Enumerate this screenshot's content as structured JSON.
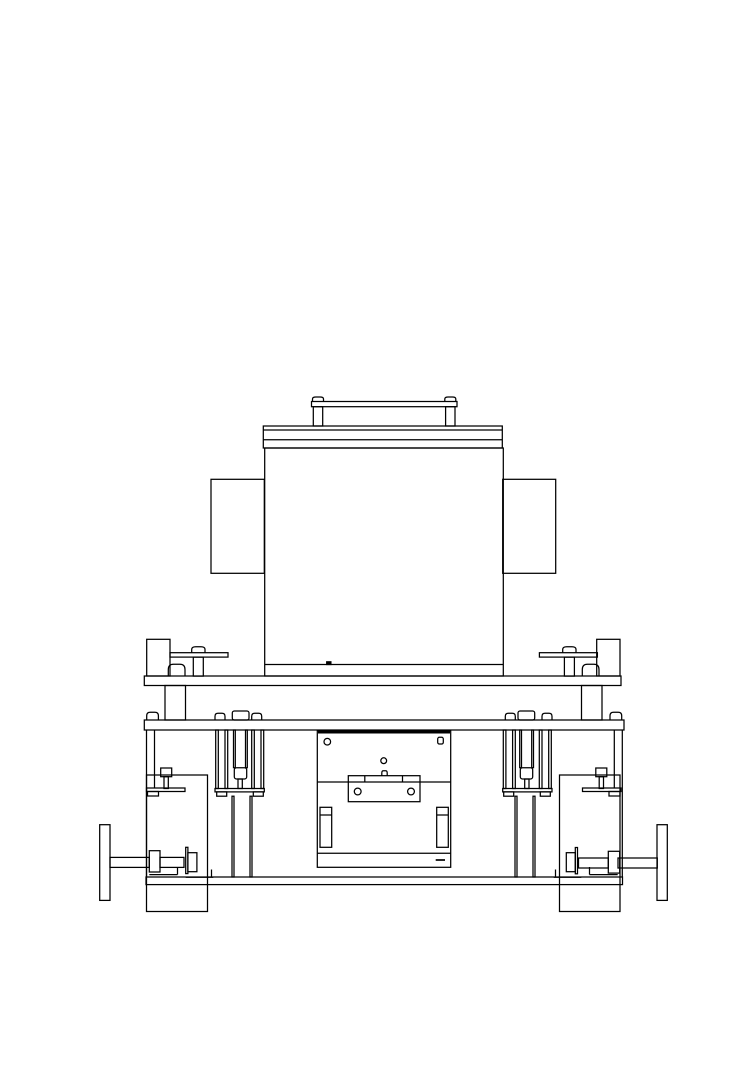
{
  "page": {
    "background": "#ffffff",
    "width": 755,
    "height": 1083
  },
  "drawing": {
    "description": "front-view-technical-line-drawing-of-machine-on-wheeled-base",
    "stroke_color": "#000000",
    "default_line_width": 1.25,
    "canvas": {
      "width": 755,
      "height": 1083
    },
    "shapes": [
      {
        "name": "lift-handle-rail",
        "type": "rect",
        "x": 311.5,
        "y": 401.5,
        "w": 145.5,
        "h": 5.2
      },
      {
        "name": "lift-handle-cap-left",
        "type": "dome",
        "x": 312.5,
        "y": 397,
        "w": 11,
        "h": 4.5
      },
      {
        "name": "lift-handle-cap-right",
        "type": "dome",
        "x": 444.8,
        "y": 397,
        "w": 11,
        "h": 4.5
      },
      {
        "name": "lift-handle-post-left",
        "type": "rect",
        "x": 313.3,
        "y": 406.7,
        "w": 9.4,
        "h": 19.3
      },
      {
        "name": "lift-handle-post-right",
        "type": "rect",
        "x": 445.6,
        "y": 406.7,
        "w": 9.4,
        "h": 19.3
      },
      {
        "name": "top-cover-plate",
        "type": "rect",
        "x": 263.3,
        "y": 426,
        "w": 239,
        "h": 22
      },
      {
        "name": "top-cover-seam-1",
        "type": "line",
        "x1": 263.3,
        "y1": 430,
        "x2": 502.3,
        "y2": 430
      },
      {
        "name": "top-cover-seam-2",
        "type": "line",
        "x1": 263.3,
        "y1": 439.7,
        "x2": 502.3,
        "y2": 439.7
      },
      {
        "name": "main-housing-body",
        "type": "rect",
        "x": 264.7,
        "y": 448,
        "w": 238.6,
        "h": 228
      },
      {
        "name": "main-housing-bottom-seam",
        "type": "line",
        "x1": 264.7,
        "y1": 664.5,
        "x2": 503.3,
        "y2": 664.5
      },
      {
        "name": "main-housing-weld-tick",
        "type": "rect",
        "x": 326.7,
        "y": 661.8,
        "w": 4.2,
        "h": 2.7,
        "fill": "black"
      },
      {
        "name": "side-flange-left",
        "type": "rect",
        "x": 211,
        "y": 479.3,
        "w": 53.3,
        "h": 94
      },
      {
        "name": "side-flange-right",
        "type": "rect",
        "x": 502.7,
        "y": 479.3,
        "w": 53,
        "h": 94
      },
      {
        "name": "clamp-block-left",
        "type": "rect",
        "x": 146.7,
        "y": 639.3,
        "w": 23.3,
        "h": 36.7
      },
      {
        "name": "clamp-block-right",
        "type": "rect",
        "x": 596.7,
        "y": 639.3,
        "w": 23.3,
        "h": 36.7
      },
      {
        "name": "clamp-lever-left",
        "type": "rect",
        "x": 170,
        "y": 652.7,
        "w": 58,
        "h": 4.4
      },
      {
        "name": "clamp-lever-right",
        "type": "rect",
        "x": 539.4,
        "y": 652.7,
        "w": 58,
        "h": 4.4
      },
      {
        "name": "clamp-lever-knob-left",
        "type": "dome",
        "x": 191.7,
        "y": 646.7,
        "w": 13.3,
        "h": 6
      },
      {
        "name": "clamp-lever-knob-right",
        "type": "dome",
        "x": 562.7,
        "y": 646.7,
        "w": 13.3,
        "h": 6
      },
      {
        "name": "clamp-lever-post-left",
        "type": "rect",
        "x": 193.3,
        "y": 657.1,
        "w": 10,
        "h": 19
      },
      {
        "name": "clamp-lever-post-right",
        "type": "rect",
        "x": 564.4,
        "y": 657.1,
        "w": 10,
        "h": 19
      },
      {
        "name": "clamp-pad-left",
        "type": "dome",
        "x": 168.3,
        "y": 664.3,
        "w": 16.7,
        "h": 11.8
      },
      {
        "name": "clamp-pad-right",
        "type": "dome",
        "x": 582.3,
        "y": 664.3,
        "w": 16.7,
        "h": 11.8
      },
      {
        "name": "support-shelf",
        "type": "rect",
        "x": 144.3,
        "y": 676,
        "w": 476.7,
        "h": 9.5
      },
      {
        "name": "shelf-column-left",
        "type": "rect",
        "x": 165,
        "y": 685.5,
        "w": 20.5,
        "h": 34.5
      },
      {
        "name": "shelf-column-right",
        "type": "rect",
        "x": 581.5,
        "y": 685.5,
        "w": 20.5,
        "h": 34.5
      },
      {
        "name": "deck-plate",
        "type": "rect",
        "x": 144.3,
        "y": 720,
        "w": 479.7,
        "h": 10
      },
      {
        "name": "deck-bolt-dome-far-left",
        "type": "dome",
        "x": 146.7,
        "y": 712.3,
        "w": 11.7,
        "h": 7.7
      },
      {
        "name": "deck-bolt-dome-far-right",
        "type": "dome",
        "x": 610,
        "y": 712.3,
        "w": 11.7,
        "h": 7.7
      },
      {
        "name": "guide-dome-left-a",
        "type": "dome",
        "x": 215,
        "y": 713.3,
        "w": 10,
        "h": 6.7
      },
      {
        "name": "guide-cap-left",
        "type": "rect",
        "x": 232.3,
        "y": 711,
        "w": 16.7,
        "h": 9,
        "rx": 2
      },
      {
        "name": "guide-dome-left-b",
        "type": "dome",
        "x": 251.7,
        "y": 713.3,
        "w": 10,
        "h": 6.7
      },
      {
        "name": "guide-rail-left-1",
        "type": "rect",
        "x": 215.7,
        "y": 730,
        "w": 2.6,
        "h": 58.5
      },
      {
        "name": "guide-rail-left-2",
        "type": "rect",
        "x": 225,
        "y": 730,
        "w": 2.7,
        "h": 58.5
      },
      {
        "name": "guide-rail-left-3",
        "type": "rect",
        "x": 251.7,
        "y": 730,
        "w": 2.6,
        "h": 58.5
      },
      {
        "name": "guide-rail-left-4",
        "type": "rect",
        "x": 261,
        "y": 730,
        "w": 2.7,
        "h": 58.5
      },
      {
        "name": "guide-screw-left-1",
        "type": "rect",
        "x": 233.5,
        "y": 730,
        "w": 1.8,
        "h": 37.7
      },
      {
        "name": "guide-screw-left-2",
        "type": "rect",
        "x": 245.5,
        "y": 730,
        "w": 1.8,
        "h": 37.7
      },
      {
        "name": "guide-nut-left",
        "type": "rect",
        "x": 234.3,
        "y": 767.7,
        "w": 12.4,
        "h": 11.3,
        "rx": 2.2
      },
      {
        "name": "guide-stem-left",
        "type": "rect",
        "x": 238,
        "y": 779,
        "w": 4.3,
        "h": 9.5
      },
      {
        "name": "guide-foot-plate-left",
        "type": "rect",
        "x": 215,
        "y": 788.5,
        "w": 49.3,
        "h": 3.4
      },
      {
        "name": "guide-foot-pad-left-1",
        "type": "rect",
        "x": 216.7,
        "y": 791.9,
        "w": 10,
        "h": 4.3
      },
      {
        "name": "guide-foot-pad-left-2",
        "type": "rect",
        "x": 253.3,
        "y": 791.9,
        "w": 10,
        "h": 4.3
      },
      {
        "name": "guide-leg-left-1",
        "type": "rect",
        "x": 232,
        "y": 796.2,
        "w": 2,
        "h": 80.8
      },
      {
        "name": "guide-leg-left-2",
        "type": "rect",
        "x": 250,
        "y": 796.2,
        "w": 2,
        "h": 80.8
      },
      {
        "name": "guide-dome-right-a",
        "type": "dome",
        "x": 542,
        "y": 713.3,
        "w": 10,
        "h": 6.7
      },
      {
        "name": "guide-cap-right",
        "type": "rect",
        "x": 518,
        "y": 711,
        "w": 16.7,
        "h": 9,
        "rx": 2
      },
      {
        "name": "guide-dome-right-b",
        "type": "dome",
        "x": 505.3,
        "y": 713.3,
        "w": 10,
        "h": 6.7
      },
      {
        "name": "guide-rail-right-1",
        "type": "rect",
        "x": 548.7,
        "y": 730,
        "w": 2.6,
        "h": 58.5
      },
      {
        "name": "guide-rail-right-2",
        "type": "rect",
        "x": 539.3,
        "y": 730,
        "w": 2.7,
        "h": 58.5
      },
      {
        "name": "guide-rail-right-3",
        "type": "rect",
        "x": 512.6,
        "y": 730,
        "w": 2.7,
        "h": 58.5
      },
      {
        "name": "guide-rail-right-4",
        "type": "rect",
        "x": 503.3,
        "y": 730,
        "w": 2.6,
        "h": 58.5
      },
      {
        "name": "guide-screw-right-1",
        "type": "rect",
        "x": 531.7,
        "y": 730,
        "w": 1.8,
        "h": 37.7
      },
      {
        "name": "guide-screw-right-2",
        "type": "rect",
        "x": 519.7,
        "y": 730,
        "w": 1.8,
        "h": 37.7
      },
      {
        "name": "guide-nut-right",
        "type": "rect",
        "x": 520.3,
        "y": 767.7,
        "w": 12.4,
        "h": 11.3,
        "rx": 2.2
      },
      {
        "name": "guide-stem-right",
        "type": "rect",
        "x": 524.7,
        "y": 779,
        "w": 4.3,
        "h": 9.5
      },
      {
        "name": "guide-foot-plate-right",
        "type": "rect",
        "x": 502.7,
        "y": 788.5,
        "w": 49.3,
        "h": 3.4
      },
      {
        "name": "guide-foot-pad-right-1",
        "type": "rect",
        "x": 503.7,
        "y": 791.9,
        "w": 10,
        "h": 4.3
      },
      {
        "name": "guide-foot-pad-right-2",
        "type": "rect",
        "x": 540.3,
        "y": 791.9,
        "w": 10,
        "h": 4.3
      },
      {
        "name": "guide-leg-right-1",
        "type": "rect",
        "x": 533,
        "y": 796.2,
        "w": 2,
        "h": 80.8
      },
      {
        "name": "guide-leg-right-2",
        "type": "rect",
        "x": 515,
        "y": 796.2,
        "w": 2,
        "h": 80.8
      },
      {
        "name": "frame-wall-left-outer",
        "type": "line",
        "x1": 146.5,
        "y1": 730,
        "x2": 146.5,
        "y2": 877
      },
      {
        "name": "frame-wall-left-inner",
        "type": "line",
        "x1": 154.5,
        "y1": 730,
        "x2": 154.5,
        "y2": 788
      },
      {
        "name": "frame-wall-right-outer",
        "type": "line",
        "x1": 622.3,
        "y1": 730,
        "x2": 622.3,
        "y2": 877
      },
      {
        "name": "frame-wall-right-inner",
        "type": "line",
        "x1": 614.3,
        "y1": 730,
        "x2": 614.3,
        "y2": 788
      },
      {
        "name": "side-cabinet-left",
        "type": "rect",
        "x": 146.5,
        "y": 775,
        "w": 61,
        "h": 136.5
      },
      {
        "name": "side-cabinet-right",
        "type": "rect",
        "x": 559.5,
        "y": 775,
        "w": 60.5,
        "h": 136.5
      },
      {
        "name": "cabinet-bolt-head-left",
        "type": "rect",
        "x": 160.7,
        "y": 768,
        "w": 11,
        "h": 8.7
      },
      {
        "name": "cabinet-bolt-stem-left",
        "type": "rect",
        "x": 164,
        "y": 776.7,
        "w": 4.3,
        "h": 11.8
      },
      {
        "name": "cabinet-bolt-plate-left",
        "type": "rect",
        "x": 146.5,
        "y": 788,
        "w": 38.5,
        "h": 3.5
      },
      {
        "name": "cabinet-bolt-pad-left",
        "type": "rect",
        "x": 147.5,
        "y": 791.5,
        "w": 11,
        "h": 4.5
      },
      {
        "name": "cabinet-bolt-head-right",
        "type": "rect",
        "x": 595.8,
        "y": 768,
        "w": 11,
        "h": 8.7
      },
      {
        "name": "cabinet-bolt-stem-right",
        "type": "rect",
        "x": 599.2,
        "y": 776.7,
        "w": 4.3,
        "h": 11.8
      },
      {
        "name": "cabinet-bolt-plate-right",
        "type": "rect",
        "x": 582.5,
        "y": 788,
        "w": 38.5,
        "h": 3.5
      },
      {
        "name": "cabinet-bolt-pad-right",
        "type": "rect",
        "x": 609,
        "y": 791.5,
        "w": 11,
        "h": 4.5
      },
      {
        "name": "center-fixture-plate",
        "type": "rect",
        "x": 317.3,
        "y": 730.7,
        "w": 133.4,
        "h": 136.6
      },
      {
        "name": "center-fixture-top-edge",
        "type": "line",
        "x1": 318,
        "y1": 732.2,
        "x2": 450,
        "y2": 732.2,
        "lw": 2.6
      },
      {
        "name": "fixture-hole-top-left",
        "type": "circle",
        "cx": 327.3,
        "cy": 741.7,
        "r": 3.3
      },
      {
        "name": "fixture-hole-top-right",
        "type": "rect",
        "x": 437.7,
        "y": 737.3,
        "w": 5.6,
        "h": 6.7,
        "rx": 1.6
      },
      {
        "name": "fixture-hole-center",
        "type": "circle",
        "cx": 383.7,
        "cy": 760.7,
        "r": 2.9
      },
      {
        "name": "fixture-tab-center",
        "type": "dome",
        "x": 381.8,
        "y": 770.8,
        "w": 5.4,
        "h": 4.9
      },
      {
        "name": "fixture-mid-seam",
        "type": "line",
        "x1": 317.3,
        "y1": 782,
        "x2": 450.7,
        "y2": 782
      },
      {
        "name": "fixture-clamp-bar",
        "type": "rect",
        "x": 348.3,
        "y": 775.7,
        "w": 71.7,
        "h": 26
      },
      {
        "name": "clamp-bar-tick-1",
        "type": "line",
        "x1": 364.8,
        "y1": 775.7,
        "x2": 364.8,
        "y2": 782
      },
      {
        "name": "clamp-bar-tick-2",
        "type": "line",
        "x1": 402.5,
        "y1": 775.7,
        "x2": 402.5,
        "y2": 782
      },
      {
        "name": "clamp-bar-hole-left",
        "type": "circle",
        "cx": 357.7,
        "cy": 791.5,
        "r": 3.4
      },
      {
        "name": "clamp-bar-hole-right",
        "type": "circle",
        "cx": 411,
        "cy": 791.5,
        "r": 3.4
      },
      {
        "name": "fixture-slot-left",
        "type": "rect",
        "x": 320,
        "y": 807.3,
        "w": 11.7,
        "h": 40
      },
      {
        "name": "fixture-slot-left-divider",
        "type": "line",
        "x1": 320,
        "y1": 815,
        "x2": 331.7,
        "y2": 815
      },
      {
        "name": "fixture-slot-right",
        "type": "rect",
        "x": 436.7,
        "y": 807.3,
        "w": 11.6,
        "h": 40
      },
      {
        "name": "fixture-slot-right-divider",
        "type": "line",
        "x1": 436.7,
        "y1": 815,
        "x2": 448.3,
        "y2": 815
      },
      {
        "name": "fixture-bottom-seam",
        "type": "line",
        "x1": 317.3,
        "y1": 853.3,
        "x2": 450.7,
        "y2": 853.3
      },
      {
        "name": "fixture-bottom-dash",
        "type": "line",
        "x1": 435.7,
        "y1": 860,
        "x2": 445,
        "y2": 860,
        "lw": 1.7
      },
      {
        "name": "caster-wheel-left",
        "type": "rect",
        "x": 99.7,
        "y": 824.7,
        "w": 10.3,
        "h": 75.7
      },
      {
        "name": "axle-outer-left",
        "type": "rect",
        "x": 110,
        "y": 857.4,
        "w": 39.3,
        "h": 10
      },
      {
        "name": "axle-flange-a-left",
        "type": "rect",
        "x": 149.3,
        "y": 850.7,
        "w": 10.7,
        "h": 21.3
      },
      {
        "name": "axle-inner-left",
        "type": "rect",
        "x": 160,
        "y": 857.4,
        "w": 24,
        "h": 10
      },
      {
        "name": "axle-flange-web-left",
        "type": "rect",
        "x": 185.7,
        "y": 847.3,
        "w": 2.2,
        "h": 26.3
      },
      {
        "name": "axle-flange-b-left",
        "type": "rect",
        "x": 187.9,
        "y": 852.7,
        "w": 9,
        "h": 19
      },
      {
        "name": "angle-bracket-left-1",
        "type": "line",
        "x1": 149.3,
        "y1": 874.6,
        "x2": 177.5,
        "y2": 874.6
      },
      {
        "name": "angle-bracket-left-1-lip",
        "type": "line",
        "x1": 177.5,
        "y1": 874.6,
        "x2": 177.5,
        "y2": 867
      },
      {
        "name": "angle-bracket-left-2",
        "type": "line",
        "x1": 185.7,
        "y1": 877.2,
        "x2": 213.3,
        "y2": 877.2
      },
      {
        "name": "angle-bracket-left-2-lip",
        "type": "line",
        "x1": 211.5,
        "y1": 877.2,
        "x2": 211.5,
        "y2": 869.5
      },
      {
        "name": "caster-wheel-right",
        "type": "rect",
        "x": 657,
        "y": 824.7,
        "w": 10.3,
        "h": 75.7
      },
      {
        "name": "axle-outer-right",
        "type": "rect",
        "x": 618,
        "y": 858,
        "w": 39.3,
        "h": 10
      },
      {
        "name": "axle-flange-a-right",
        "type": "rect",
        "x": 608.3,
        "y": 851.3,
        "w": 11.4,
        "h": 21.8
      },
      {
        "name": "axle-inner-right",
        "type": "rect",
        "x": 578.5,
        "y": 858,
        "w": 29.8,
        "h": 10
      },
      {
        "name": "axle-flange-web-right",
        "type": "rect",
        "x": 575.3,
        "y": 847.5,
        "w": 2.2,
        "h": 26.3
      },
      {
        "name": "axle-flange-b-right",
        "type": "rect",
        "x": 566.3,
        "y": 852.7,
        "w": 9,
        "h": 19
      },
      {
        "name": "angle-bracket-right-1",
        "type": "line",
        "x1": 589.5,
        "y1": 874.6,
        "x2": 617.7,
        "y2": 874.6
      },
      {
        "name": "angle-bracket-right-1-lip",
        "type": "line",
        "x1": 589.5,
        "y1": 874.6,
        "x2": 589.5,
        "y2": 867
      },
      {
        "name": "angle-bracket-right-2",
        "type": "line",
        "x1": 553.7,
        "y1": 877.2,
        "x2": 581.3,
        "y2": 877.2
      },
      {
        "name": "angle-bracket-right-2-lip",
        "type": "line",
        "x1": 555.5,
        "y1": 877.2,
        "x2": 555.5,
        "y2": 869.5
      },
      {
        "name": "base-plate",
        "type": "rect",
        "x": 146,
        "y": 877,
        "w": 476.5,
        "h": 7.6
      }
    ]
  }
}
